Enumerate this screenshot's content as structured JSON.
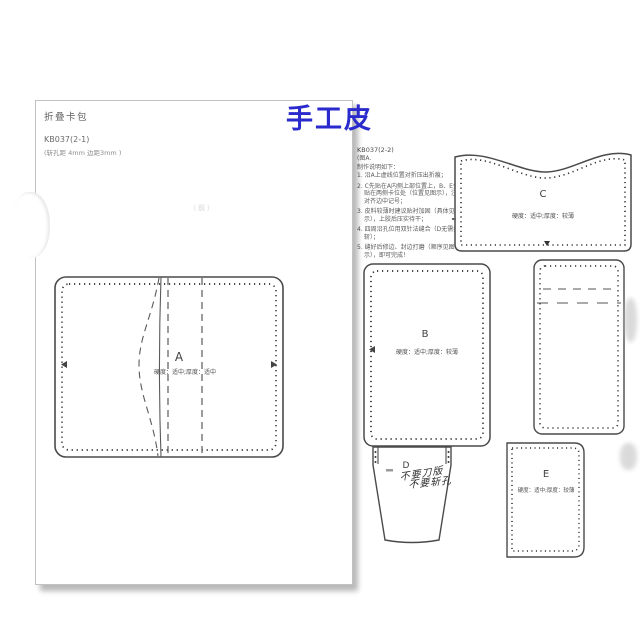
{
  "watermark": {
    "text": "手工皮",
    "color": "#2a2acd"
  },
  "left_page": {
    "title": "折叠卡包",
    "code": "KB037(2-1)",
    "spec": "(斩孔距 4mm 边距3mm )",
    "faint_note": "（前）",
    "piece_a": {
      "label": "A",
      "note": "硬度：适中;厚度：适中"
    }
  },
  "right_page": {
    "code": "KB037(2-2)",
    "fig_label": "(图A.",
    "intro": "制作说明如下：",
    "steps": [
      {
        "num": "1.",
        "text": "沿A上虚线位置对折压出折痕；"
      },
      {
        "num": "2.",
        "text": "C先贴在A内侧上部位置上，B、E分别贴在两侧卡位处（位置见图示），注意对齐边中记号；"
      },
      {
        "num": "3.",
        "text": "皮料较薄时建议贴衬加固（具体见图示），上胶后压实待干；"
      },
      {
        "num": "4.",
        "text": "四周沿孔位用双针法缝合（D无需打斩）；"
      },
      {
        "num": "5.",
        "text": "缝好后修边、封边打磨（顺序见图示），即可完成！"
      }
    ],
    "piece_b": {
      "label": "B",
      "note": "硬度：适中;厚度：较薄"
    },
    "piece_c": {
      "label": "C",
      "note": "硬度：适中;厚度：较薄"
    },
    "piece_d": {
      "label": "D",
      "handwriting": [
        "不要刀版",
        "不要斩孔"
      ]
    },
    "piece_e": {
      "label": "E",
      "note": "硬度：适中;厚度：较薄"
    }
  },
  "colors": {
    "accent_blue": "#2a2acd",
    "pattern_line": "#4a4a4a",
    "page_shadow": "#9f9f9f"
  }
}
